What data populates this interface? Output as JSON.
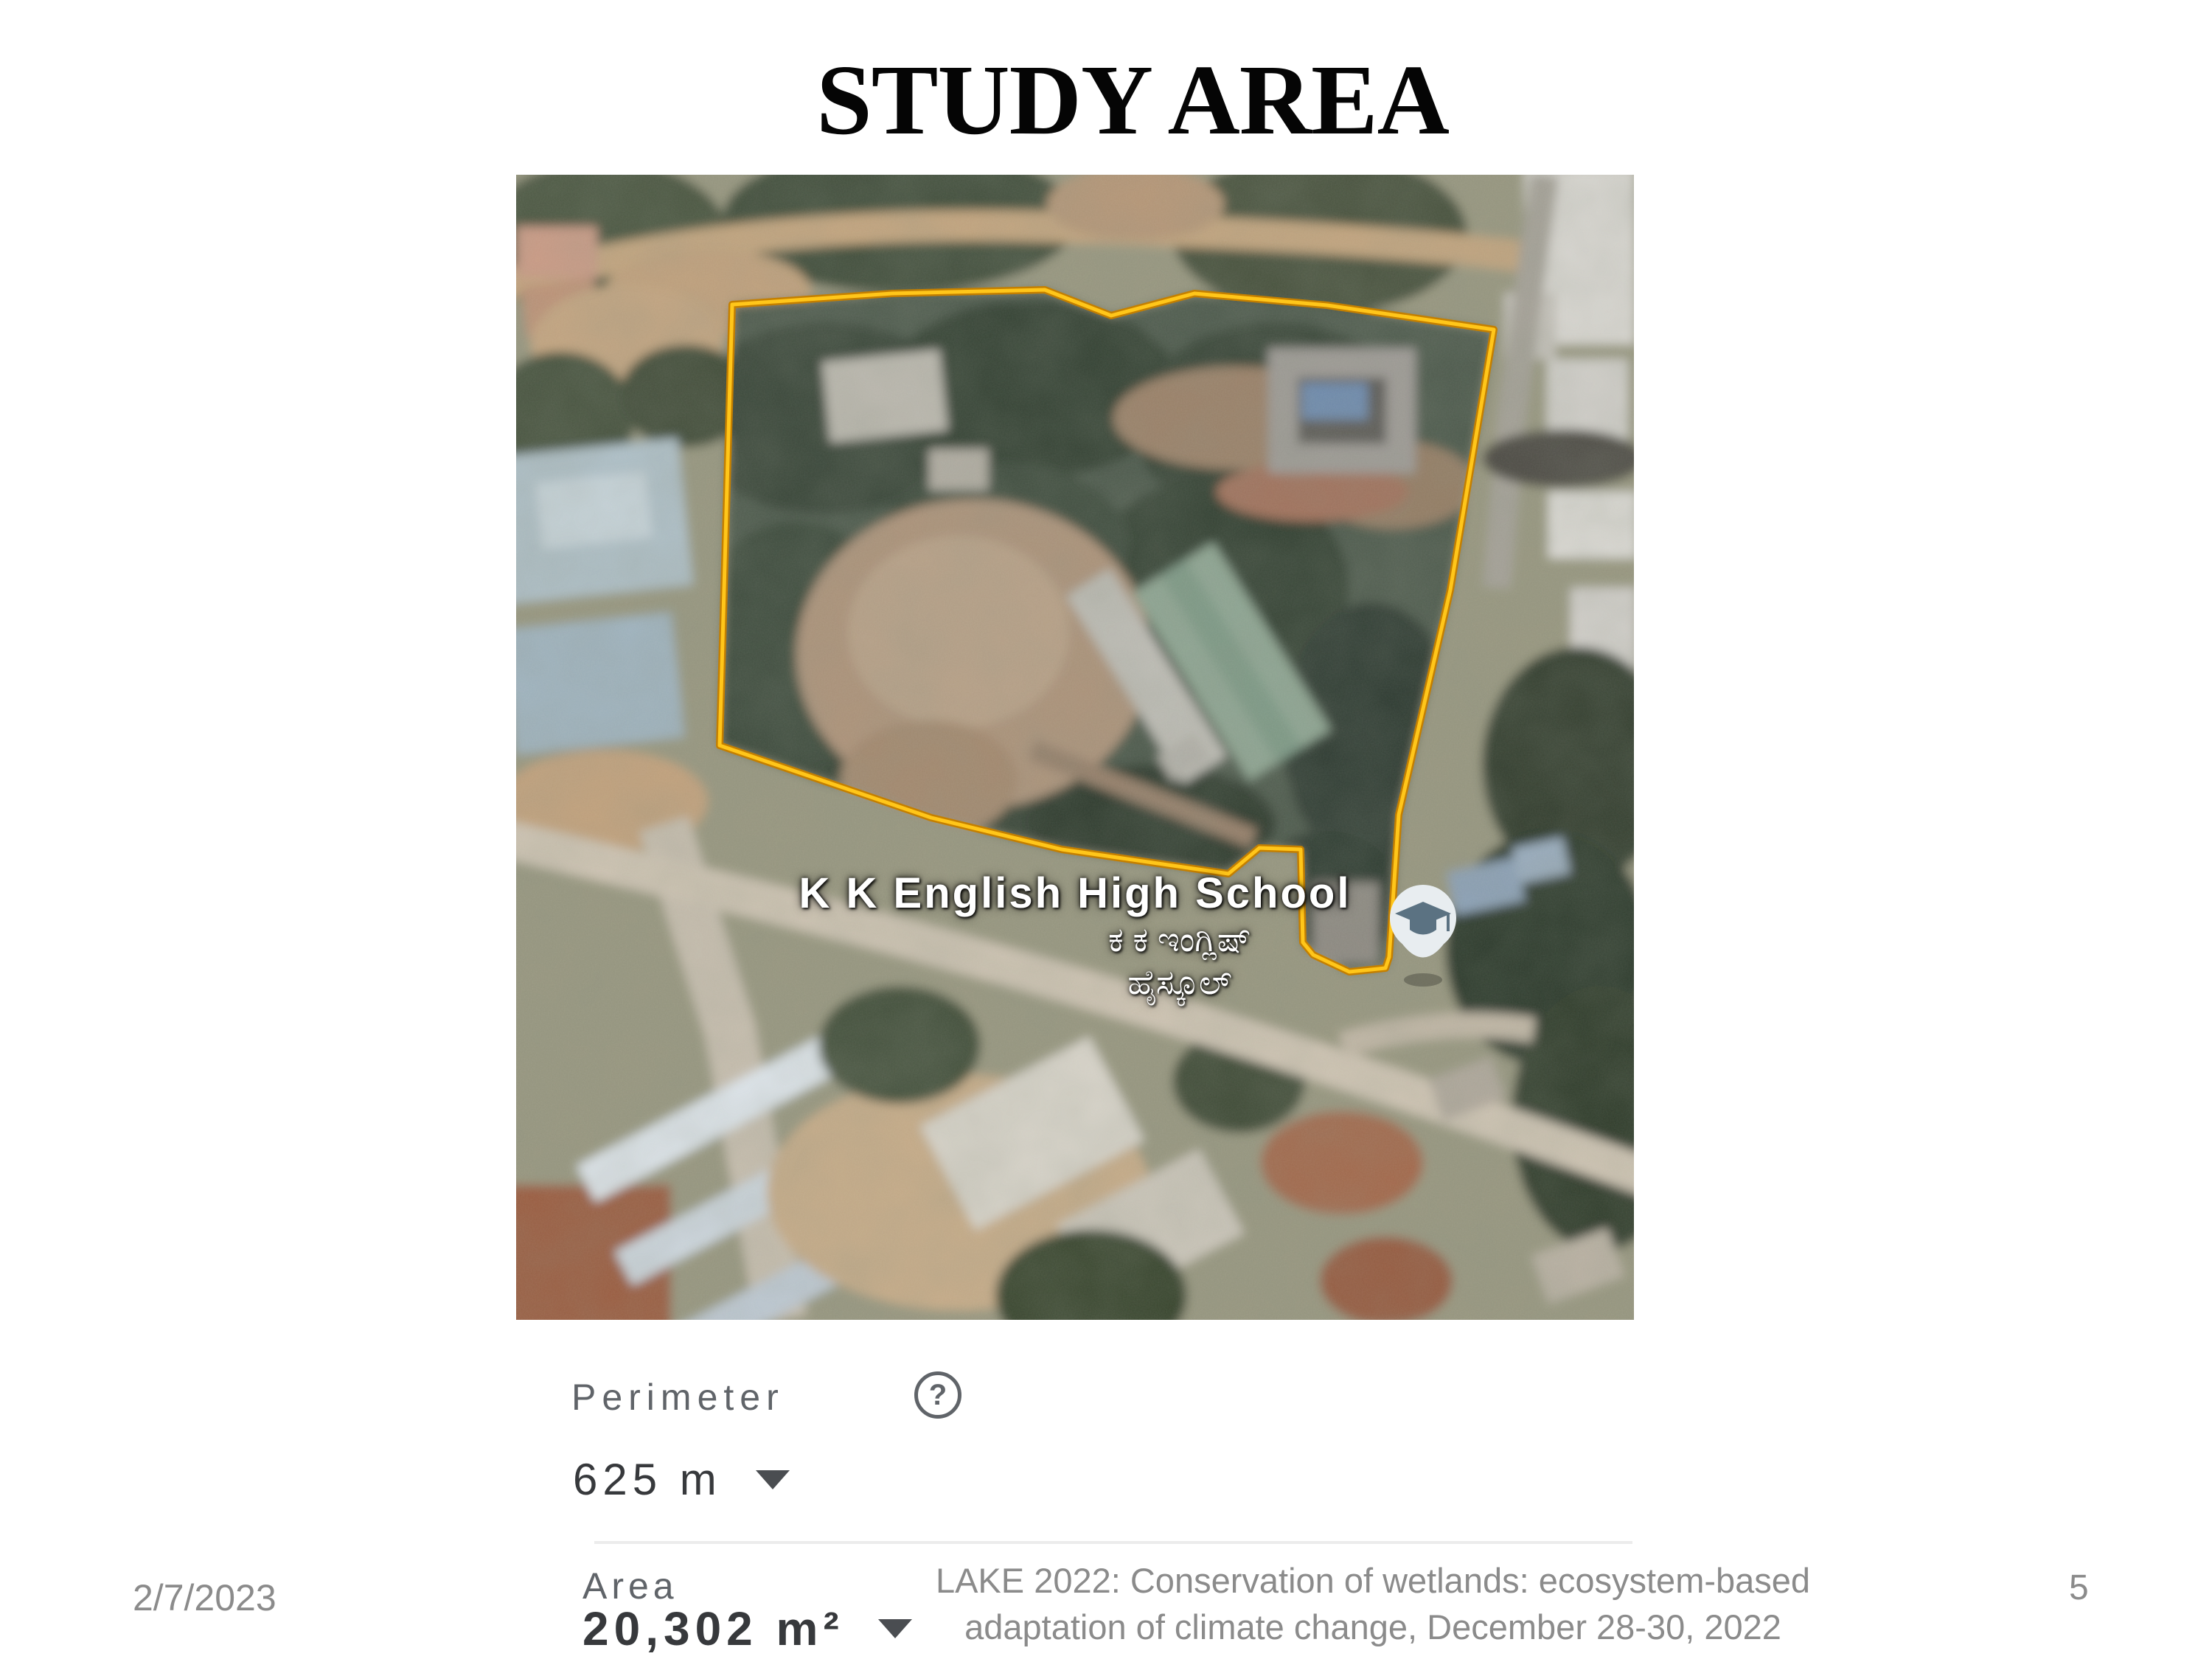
{
  "slide": {
    "title": "STUDY AREA",
    "footer": {
      "date": "2/7/2023",
      "line1": "LAKE 2022: Conservation of wetlands: ecosystem-based",
      "line2": "adaptation of climate change, December 28-30, 2022",
      "page": "5"
    }
  },
  "map": {
    "school_label": {
      "line1": "K K English High School",
      "line2": "ಕ ಕ ಇಂಗ್ಲಿಷ್",
      "line3": "ಹೈಸ್ಕೂಲ್"
    },
    "pin_icon": "graduation-cap-school-pin",
    "boundary_color": "#f4b400"
  },
  "measure_panel": {
    "perimeter_label": "Perimeter",
    "perimeter_value": "625 m",
    "help_glyph": "?",
    "area_label": "Area",
    "area_value": "20,302 m²"
  }
}
